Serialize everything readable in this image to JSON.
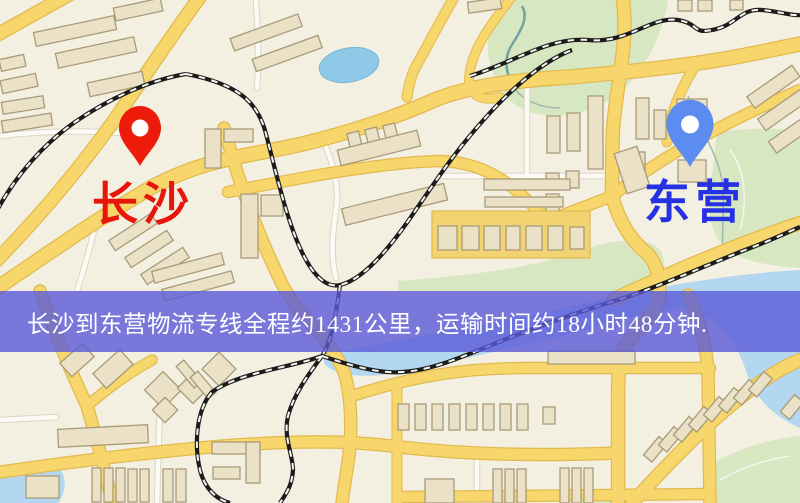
{
  "banner": {
    "text": "长沙到东营物流专线全程约1431公里，运输时间约18小时48分钟."
  },
  "origin": {
    "label": "长沙"
  },
  "destination": {
    "label": "东营"
  },
  "colors": {
    "origin_pin": "#ed1b0a",
    "origin_label": "#e8150a",
    "destination_pin": "#5c8cf0",
    "destination_label": "#2531e3",
    "banner_bg": "#5a5ad8",
    "banner_text": "#ffffff",
    "road_major": "#f7d76c",
    "road_casing": "#e2b94e",
    "map_background": "#f3efe1",
    "park_green": "#d7e7c1",
    "water_blue": "#b3d7f1",
    "railway_dark": "#1c1c1c"
  }
}
